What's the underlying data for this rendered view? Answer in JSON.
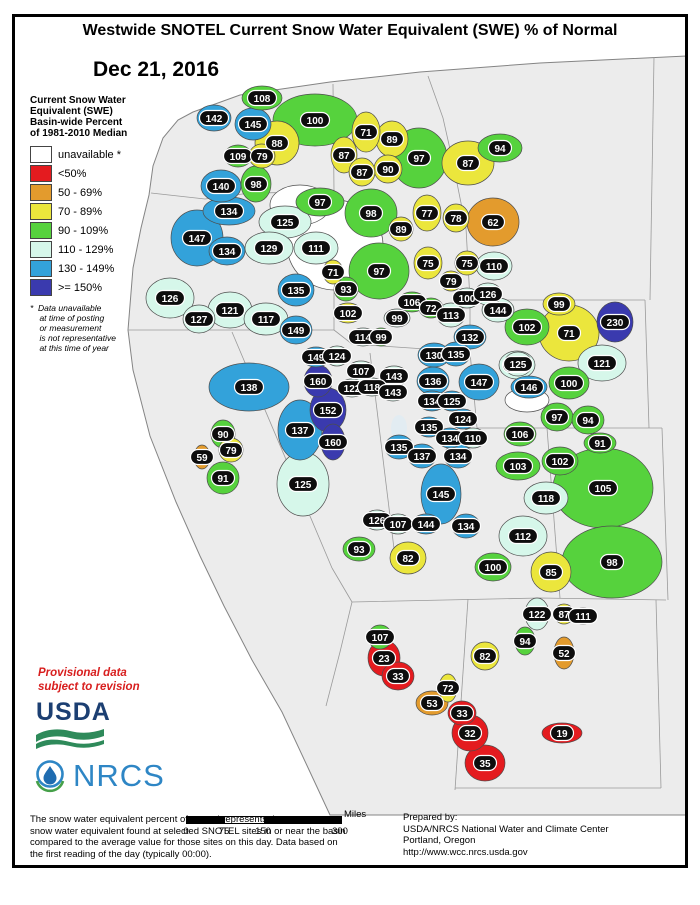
{
  "title": "Westwide SNOTEL Current Snow Water Equivalent (SWE) % of Normal",
  "date": "Dec 21, 2016",
  "legend": {
    "title_lines": [
      "Current Snow Water",
      "Equivalent (SWE)",
      "Basin-wide Percent",
      "of 1981-2010 Median"
    ],
    "items": [
      {
        "label": "unavailable *",
        "c": "na"
      },
      {
        "label": "<50%",
        "c": "r"
      },
      {
        "label": "50 - 69%",
        "c": "o"
      },
      {
        "label": "70 - 89%",
        "c": "y"
      },
      {
        "label": "90 - 109%",
        "c": "g"
      },
      {
        "label": "110 - 129%",
        "c": "p"
      },
      {
        "label": "130 - 149%",
        "c": "b"
      },
      {
        "label": ">= 150%",
        "c": "d"
      }
    ],
    "footnote_lines": [
      "*  Data unavailable",
      "    at time of posting",
      "    or measurement",
      "    is not representative",
      "    at this time of year"
    ]
  },
  "colors": {
    "na": "#ffffff",
    "r": "#e41b1f",
    "o": "#e39b2d",
    "y": "#ebe63c",
    "g": "#56d23d",
    "p": "#d6f7ea",
    "b": "#33a2da",
    "d": "#3a3aae"
  },
  "provisional_lines": [
    "Provisional data",
    "subject to revision"
  ],
  "logos": {
    "usda": "USDA",
    "nrcs": "NRCS"
  },
  "scale_bar": {
    "ticks": [
      "0",
      "75",
      "150",
      "300"
    ],
    "unit": "Miles"
  },
  "footer": {
    "left_lines": [
      "The snow water equivalent percent of normal represents the current",
      "snow water equivalent found at selected SNOTEL sites in or near the basin",
      "compared to the average value for those sites on this day. Data based on",
      "the first reading of the day (typically 00:00)."
    ],
    "right_lines": [
      "Prepared by:",
      "USDA/NRCS National Water and Climate Center",
      "Portland, Oregon",
      "http://www.wcc.nrcs.usda.gov"
    ]
  },
  "map": {
    "basins": [
      {
        "v": "142",
        "x": 214,
        "y": 118,
        "c": "b",
        "rx": 17,
        "ry": 13
      },
      {
        "v": "108",
        "x": 262,
        "y": 98,
        "c": "g",
        "rx": 20,
        "ry": 12
      },
      {
        "v": "145",
        "x": 253,
        "y": 124,
        "c": "b",
        "rx": 18,
        "ry": 16
      },
      {
        "v": "100",
        "x": 315,
        "y": 120,
        "c": "g",
        "rx": 42,
        "ry": 26
      },
      {
        "v": "88",
        "x": 277,
        "y": 143,
        "c": "y",
        "rx": 22,
        "ry": 22
      },
      {
        "v": "109",
        "x": 238,
        "y": 156,
        "c": "g",
        "rx": 14,
        "ry": 11
      },
      {
        "v": "79",
        "x": 262,
        "y": 156,
        "c": "y",
        "rx": 13,
        "ry": 12
      },
      {
        "v": "140",
        "x": 221,
        "y": 186,
        "c": "b",
        "rx": 20,
        "ry": 16
      },
      {
        "v": "98",
        "x": 256,
        "y": 184,
        "c": "g",
        "rx": 15,
        "ry": 18
      },
      {
        "v": "71",
        "x": 366,
        "y": 132,
        "c": "y",
        "rx": 14,
        "ry": 20
      },
      {
        "v": "89",
        "x": 392,
        "y": 139,
        "c": "y",
        "rx": 16,
        "ry": 18
      },
      {
        "v": "87",
        "x": 344,
        "y": 155,
        "c": "y",
        "rx": 13,
        "ry": 18
      },
      {
        "v": "90",
        "x": 388,
        "y": 169,
        "c": "y",
        "rx": 14,
        "ry": 14
      },
      {
        "v": "87",
        "x": 362,
        "y": 172,
        "c": "y",
        "rx": 13,
        "ry": 14
      },
      {
        "v": "97",
        "x": 419,
        "y": 158,
        "c": "g",
        "rx": 28,
        "ry": 30
      },
      {
        "v": "94",
        "x": 500,
        "y": 148,
        "c": "g",
        "rx": 22,
        "ry": 14
      },
      {
        "v": "87",
        "x": 468,
        "y": 163,
        "c": "y",
        "rx": 26,
        "ry": 22
      },
      {
        "v": "62",
        "x": 493,
        "y": 222,
        "c": "o",
        "rx": 26,
        "ry": 24
      },
      {
        "v": "77",
        "x": 427,
        "y": 213,
        "c": "y",
        "rx": 14,
        "ry": 18
      },
      {
        "v": "78",
        "x": 456,
        "y": 218,
        "c": "y",
        "rx": 13,
        "ry": 14
      },
      {
        "v": "98",
        "x": 371,
        "y": 213,
        "c": "g",
        "rx": 26,
        "ry": 24
      },
      {
        "v": "89",
        "x": 401,
        "y": 229,
        "c": "y",
        "rx": 12,
        "ry": 12
      },
      {
        "v": "97",
        "x": 320,
        "y": 202,
        "c": "g",
        "rx": 24,
        "ry": 14
      },
      {
        "v": "134",
        "x": 229,
        "y": 211,
        "c": "b",
        "rx": 26,
        "ry": 14
      },
      {
        "v": "125",
        "x": 285,
        "y": 222,
        "c": "p",
        "rx": 26,
        "ry": 16
      },
      {
        "v": "147",
        "x": 197,
        "y": 238,
        "c": "b",
        "rx": 26,
        "ry": 28
      },
      {
        "v": "129",
        "x": 269,
        "y": 248,
        "c": "p",
        "rx": 24,
        "ry": 16
      },
      {
        "v": "111",
        "x": 316,
        "y": 248,
        "c": "p",
        "rx": 22,
        "ry": 16
      },
      {
        "v": "134",
        "x": 227,
        "y": 251,
        "c": "b",
        "rx": 18,
        "ry": 14
      },
      {
        "v": "126",
        "x": 170,
        "y": 298,
        "c": "p",
        "rx": 24,
        "ry": 20
      },
      {
        "v": "121",
        "x": 230,
        "y": 310,
        "c": "p",
        "rx": 22,
        "ry": 18
      },
      {
        "v": "127",
        "x": 199,
        "y": 319,
        "c": "p",
        "rx": 16,
        "ry": 14
      },
      {
        "v": "117",
        "x": 266,
        "y": 319,
        "c": "p",
        "rx": 22,
        "ry": 16
      },
      {
        "v": "135",
        "x": 296,
        "y": 290,
        "c": "b",
        "rx": 18,
        "ry": 16
      },
      {
        "v": "149",
        "x": 296,
        "y": 330,
        "c": "b",
        "rx": 16,
        "ry": 14
      },
      {
        "v": "71",
        "x": 333,
        "y": 272,
        "c": "y",
        "rx": 10,
        "ry": 12
      },
      {
        "v": "97",
        "x": 379,
        "y": 271,
        "c": "g",
        "rx": 30,
        "ry": 28
      },
      {
        "v": "93",
        "x": 346,
        "y": 289,
        "c": "g",
        "rx": 12,
        "ry": 12
      },
      {
        "v": "106",
        "x": 412,
        "y": 302,
        "c": "g",
        "rx": 14,
        "ry": 10
      },
      {
        "v": "72",
        "x": 431,
        "y": 308,
        "c": "g",
        "rx": 12,
        "ry": 10
      },
      {
        "v": "102",
        "x": 348,
        "y": 313,
        "c": "y",
        "rx": 14,
        "ry": 10
      },
      {
        "v": "99",
        "x": 397,
        "y": 318,
        "c": "p",
        "rx": 13,
        "ry": 9
      },
      {
        "v": "114",
        "x": 363,
        "y": 337,
        "c": "p",
        "rx": 13,
        "ry": 9
      },
      {
        "v": "99",
        "x": 381,
        "y": 337,
        "c": "g",
        "rx": 10,
        "ry": 9
      },
      {
        "v": "113",
        "x": 451,
        "y": 315,
        "c": "p",
        "rx": 14,
        "ry": 12
      },
      {
        "v": "100",
        "x": 467,
        "y": 298,
        "c": "p",
        "rx": 13,
        "ry": 10
      },
      {
        "v": "126",
        "x": 488,
        "y": 294,
        "c": "p",
        "rx": 14,
        "ry": 11
      },
      {
        "v": "144",
        "x": 498,
        "y": 310,
        "c": "p",
        "rx": 16,
        "ry": 12
      },
      {
        "v": "75",
        "x": 428,
        "y": 263,
        "c": "y",
        "rx": 14,
        "ry": 16
      },
      {
        "v": "75",
        "x": 467,
        "y": 263,
        "c": "y",
        "rx": 12,
        "ry": 12
      },
      {
        "v": "110",
        "x": 494,
        "y": 266,
        "c": "p",
        "rx": 18,
        "ry": 14
      },
      {
        "v": "79",
        "x": 451,
        "y": 281,
        "c": "y",
        "rx": 11,
        "ry": 10
      },
      {
        "v": "149",
        "x": 316,
        "y": 357,
        "c": "b",
        "rx": 14,
        "ry": 10
      },
      {
        "v": "124",
        "x": 337,
        "y": 356,
        "c": "p",
        "rx": 12,
        "ry": 10
      },
      {
        "v": "107",
        "x": 361,
        "y": 371,
        "c": "p",
        "rx": 14,
        "ry": 10
      },
      {
        "v": "143",
        "x": 394,
        "y": 376,
        "c": "p",
        "rx": 14,
        "ry": 10
      },
      {
        "v": "122",
        "x": 352,
        "y": 388,
        "c": "p",
        "rx": 13,
        "ry": 9
      },
      {
        "v": "118",
        "x": 372,
        "y": 387,
        "c": "p",
        "rx": 13,
        "ry": 9
      },
      {
        "v": "143",
        "x": 393,
        "y": 392,
        "c": "p",
        "rx": 13,
        "ry": 9
      },
      {
        "v": "99",
        "x": 559,
        "y": 304,
        "c": "y",
        "rx": 16,
        "ry": 11
      },
      {
        "v": "102",
        "x": 527,
        "y": 327,
        "c": "g",
        "rx": 22,
        "ry": 18
      },
      {
        "v": "71",
        "x": 569,
        "y": 333,
        "c": "y",
        "rx": 30,
        "ry": 28
      },
      {
        "v": "230",
        "x": 615,
        "y": 322,
        "c": "d",
        "rx": 18,
        "ry": 20
      },
      {
        "v": "121",
        "x": 602,
        "y": 363,
        "c": "p",
        "rx": 24,
        "ry": 18
      },
      {
        "v": "125",
        "x": 517,
        "y": 365,
        "c": "p",
        "rx": 18,
        "ry": 14
      },
      {
        "v": "146",
        "x": 529,
        "y": 387,
        "c": "b",
        "rx": 18,
        "ry": 11
      },
      {
        "v": "100",
        "x": 569,
        "y": 383,
        "c": "g",
        "rx": 20,
        "ry": 16
      },
      {
        "v": "97",
        "x": 557,
        "y": 417,
        "c": "g",
        "rx": 16,
        "ry": 14
      },
      {
        "v": "94",
        "x": 588,
        "y": 420,
        "c": "g",
        "rx": 16,
        "ry": 14
      },
      {
        "v": "91",
        "x": 600,
        "y": 443,
        "c": "g",
        "rx": 16,
        "ry": 10
      },
      {
        "v": "106",
        "x": 520,
        "y": 434,
        "c": "g",
        "rx": 16,
        "ry": 12
      },
      {
        "v": "132",
        "x": 470,
        "y": 337,
        "c": "b",
        "rx": 16,
        "ry": 12
      },
      {
        "v": "130",
        "x": 434,
        "y": 355,
        "c": "b",
        "rx": 16,
        "ry": 12
      },
      {
        "v": "135",
        "x": 456,
        "y": 354,
        "c": "b",
        "rx": 14,
        "ry": 12
      },
      {
        "v": "136",
        "x": 433,
        "y": 381,
        "c": "b",
        "rx": 16,
        "ry": 14
      },
      {
        "v": "147",
        "x": 479,
        "y": 382,
        "c": "b",
        "rx": 20,
        "ry": 18
      },
      {
        "v": "125",
        "x": 518,
        "y": 364,
        "c": "p",
        "rx": 14,
        "ry": 12
      },
      {
        "v": "134",
        "x": 432,
        "y": 401,
        "c": "b",
        "rx": 14,
        "ry": 10
      },
      {
        "v": "125",
        "x": 452,
        "y": 401,
        "c": "b",
        "rx": 13,
        "ry": 10
      },
      {
        "v": "124",
        "x": 463,
        "y": 419,
        "c": "b",
        "rx": 13,
        "ry": 10
      },
      {
        "v": "135",
        "x": 429,
        "y": 427,
        "c": "b",
        "rx": 13,
        "ry": 10
      },
      {
        "v": "134",
        "x": 450,
        "y": 438,
        "c": "b",
        "rx": 13,
        "ry": 10
      },
      {
        "v": "110",
        "x": 473,
        "y": 438,
        "c": "p",
        "rx": 13,
        "ry": 10
      },
      {
        "v": "135",
        "x": 399,
        "y": 447,
        "c": "b",
        "rx": 14,
        "ry": 12
      },
      {
        "v": "137",
        "x": 422,
        "y": 456,
        "c": "b",
        "rx": 14,
        "ry": 12
      },
      {
        "v": "134",
        "x": 458,
        "y": 456,
        "c": "b",
        "rx": 14,
        "ry": 12
      },
      {
        "v": "145",
        "x": 441,
        "y": 494,
        "c": "b",
        "rx": 20,
        "ry": 30
      },
      {
        "v": "126",
        "x": 377,
        "y": 520,
        "c": "p",
        "rx": 13,
        "ry": 10
      },
      {
        "v": "107",
        "x": 398,
        "y": 524,
        "c": "p",
        "rx": 13,
        "ry": 10
      },
      {
        "v": "144",
        "x": 426,
        "y": 524,
        "c": "b",
        "rx": 14,
        "ry": 10
      },
      {
        "v": "134",
        "x": 466,
        "y": 526,
        "c": "b",
        "rx": 14,
        "ry": 12
      },
      {
        "v": "93",
        "x": 359,
        "y": 549,
        "c": "g",
        "rx": 16,
        "ry": 12
      },
      {
        "v": "82",
        "x": 408,
        "y": 558,
        "c": "y",
        "rx": 18,
        "ry": 16
      },
      {
        "v": "103",
        "x": 518,
        "y": 466,
        "c": "g",
        "rx": 22,
        "ry": 14
      },
      {
        "v": "118",
        "x": 546,
        "y": 498,
        "c": "p",
        "rx": 22,
        "ry": 16
      },
      {
        "v": "112",
        "x": 523,
        "y": 536,
        "c": "p",
        "rx": 24,
        "ry": 20
      },
      {
        "v": "100",
        "x": 493,
        "y": 567,
        "c": "g",
        "rx": 18,
        "ry": 14
      },
      {
        "v": "85",
        "x": 551,
        "y": 572,
        "c": "y",
        "rx": 20,
        "ry": 20
      },
      {
        "v": "102",
        "x": 560,
        "y": 461,
        "c": "g",
        "rx": 18,
        "ry": 14
      },
      {
        "v": "105",
        "x": 603,
        "y": 488,
        "c": "g",
        "rx": 50,
        "ry": 40
      },
      {
        "v": "98",
        "x": 612,
        "y": 562,
        "c": "g",
        "rx": 50,
        "ry": 36
      },
      {
        "v": "122",
        "x": 537,
        "y": 614,
        "c": "p",
        "rx": 12,
        "ry": 16
      },
      {
        "v": "87",
        "x": 564,
        "y": 614,
        "c": "y",
        "rx": 10,
        "ry": 10
      },
      {
        "v": "111",
        "x": 583,
        "y": 616,
        "c": "p",
        "rx": 12,
        "ry": 8
      },
      {
        "v": "94",
        "x": 525,
        "y": 641,
        "c": "g",
        "rx": 10,
        "ry": 14
      },
      {
        "v": "52",
        "x": 564,
        "y": 653,
        "c": "o",
        "rx": 10,
        "ry": 16
      },
      {
        "v": "107",
        "x": 380,
        "y": 637,
        "c": "g",
        "rx": 12,
        "ry": 12
      },
      {
        "v": "23",
        "x": 384,
        "y": 658,
        "c": "r",
        "rx": 16,
        "ry": 18
      },
      {
        "v": "33",
        "x": 398,
        "y": 676,
        "c": "r",
        "rx": 16,
        "ry": 14
      },
      {
        "v": "82",
        "x": 485,
        "y": 656,
        "c": "y",
        "rx": 14,
        "ry": 14
      },
      {
        "v": "72",
        "x": 448,
        "y": 688,
        "c": "y",
        "rx": 9,
        "ry": 14
      },
      {
        "v": "53",
        "x": 432,
        "y": 703,
        "c": "o",
        "rx": 16,
        "ry": 12
      },
      {
        "v": "33",
        "x": 462,
        "y": 713,
        "c": "r",
        "rx": 14,
        "ry": 12
      },
      {
        "v": "32",
        "x": 470,
        "y": 733,
        "c": "r",
        "rx": 18,
        "ry": 18
      },
      {
        "v": "35",
        "x": 485,
        "y": 763,
        "c": "r",
        "rx": 20,
        "ry": 18
      },
      {
        "v": "19",
        "x": 562,
        "y": 733,
        "c": "r",
        "rx": 20,
        "ry": 10
      },
      {
        "v": "138",
        "x": 249,
        "y": 387,
        "c": "b",
        "rx": 40,
        "ry": 24
      },
      {
        "v": "160",
        "x": 318,
        "y": 381,
        "c": "d",
        "rx": 14,
        "ry": 16
      },
      {
        "v": "152",
        "x": 328,
        "y": 410,
        "c": "d",
        "rx": 18,
        "ry": 22
      },
      {
        "v": "137",
        "x": 300,
        "y": 430,
        "c": "b",
        "rx": 22,
        "ry": 30
      },
      {
        "v": "160",
        "x": 333,
        "y": 442,
        "c": "d",
        "rx": 12,
        "ry": 18
      },
      {
        "v": "90",
        "x": 223,
        "y": 434,
        "c": "g",
        "rx": 12,
        "ry": 14
      },
      {
        "v": "79",
        "x": 231,
        "y": 450,
        "c": "y",
        "rx": 12,
        "ry": 12
      },
      {
        "v": "59",
        "x": 202,
        "y": 457,
        "c": "o",
        "rx": 8,
        "ry": 12
      },
      {
        "v": "91",
        "x": 223,
        "y": 478,
        "c": "g",
        "rx": 16,
        "ry": 16
      },
      {
        "v": "125",
        "x": 303,
        "y": 484,
        "c": "p",
        "rx": 26,
        "ry": 32
      },
      {
        "v": "",
        "x": 335,
        "y": 245,
        "c": "na",
        "rx": 48,
        "ry": 45
      },
      {
        "v": "",
        "x": 300,
        "y": 205,
        "c": "na",
        "rx": 30,
        "ry": 20
      },
      {
        "v": "",
        "x": 527,
        "y": 400,
        "c": "na",
        "rx": 22,
        "ry": 12
      }
    ]
  }
}
